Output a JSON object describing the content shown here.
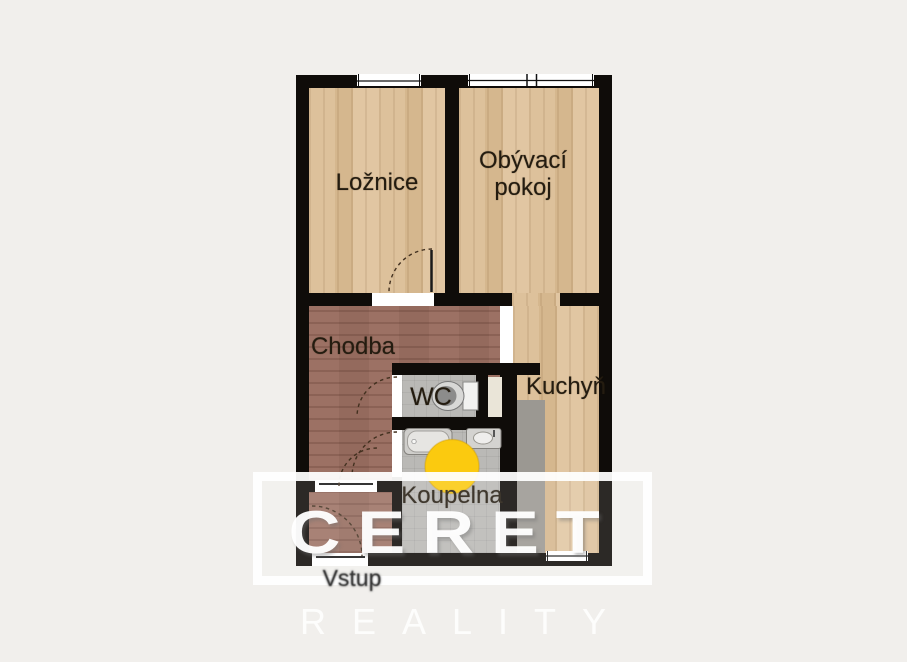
{
  "palette": {
    "page-bg": "#f1efec",
    "wall": "#0f0c09",
    "wood": "#ddc19b",
    "hall": "#9c7164",
    "tile": "#bab9b6",
    "counter": "#9b9892",
    "shaft": "#eae5d8",
    "door-white": "#ffffff",
    "marker-yellow": "#fbca0f",
    "label": "#241c10",
    "watermark-white": "#ffffff"
  },
  "rooms": {
    "loznice": {
      "label": "Ložnice"
    },
    "obyvaci_pokoj": {
      "label": "Obývací pokoj"
    },
    "chodba": {
      "label": "Chodba"
    },
    "wc": {
      "label": "WC"
    },
    "kuchyn": {
      "label": "Kuchyň"
    },
    "koupelna": {
      "label": "Koupelna"
    }
  },
  "entrance": {
    "label": "Vstup"
  },
  "watermark": {
    "brand": "CERET",
    "subtitle": "REALITY"
  },
  "fixtures": [
    "toilet-icon",
    "bathtub-icon",
    "sink-icon",
    "yellow-circle-marker"
  ]
}
